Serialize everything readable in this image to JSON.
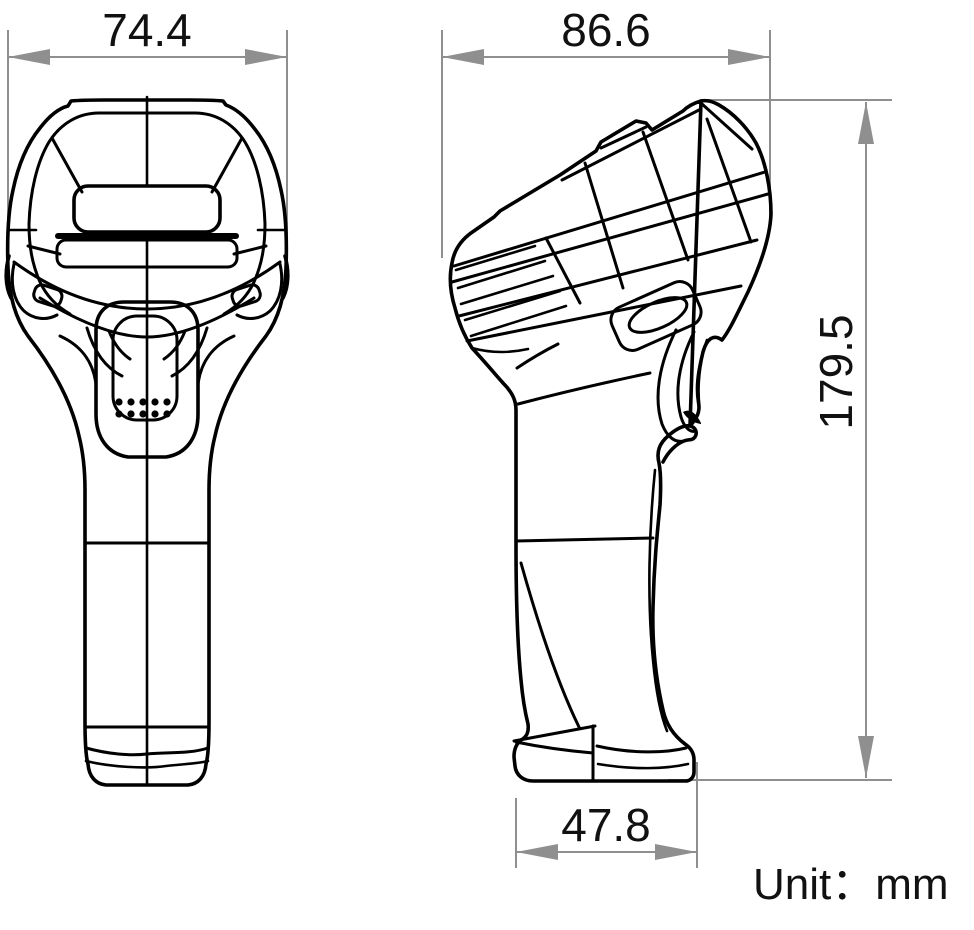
{
  "drawing": {
    "description": "Handheld barcode scanner dimensional drawing, front view and side view",
    "unit_label": "Unit：mm",
    "dims": {
      "front_width": "74.4",
      "side_depth": "86.6",
      "overall_height": "179.5",
      "base_depth": "47.8"
    },
    "colors": {
      "dimension_gray": "#8f8f8f",
      "line_black": "#000000",
      "background": "#ffffff"
    }
  }
}
